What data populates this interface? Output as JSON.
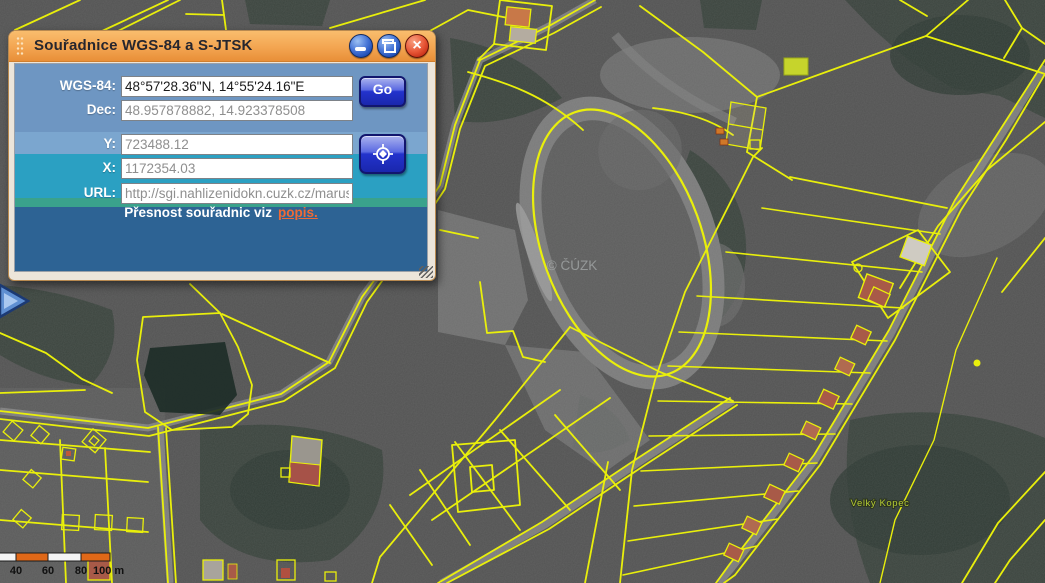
{
  "dialog": {
    "title": "Souřadnice WGS-84 a S-JTSK",
    "fields": [
      {
        "label": "WGS-84:",
        "value": "48°57'28.36\"N, 14°55'24.16\"E"
      },
      {
        "label": "Dec:",
        "value": "48.957878882, 14.923378508"
      },
      {
        "label": "Y:",
        "value": "723488.12"
      },
      {
        "label": "X:",
        "value": "1172354.03"
      },
      {
        "label": "URL:",
        "value": "http://sgi.nahlizenidokn.cuzk.cz/marus"
      }
    ],
    "go_label": "Go",
    "note_text": "Přesnost souřadnic viz",
    "note_link": "popis.",
    "icons": {
      "minimize": "minimize-icon",
      "restore": "restore-icon",
      "close": "close-icon",
      "crosshair": "crosshair-target-icon",
      "drag": "drag-handle-dots-icon",
      "resize": "resize-grip-icon"
    },
    "colors": {
      "title_bar_orange": "#f3a551",
      "band_steel_blue": "#6e96c2",
      "band_teal": "#2ba0c2",
      "band_green": "#3aa28c",
      "band_navy": "#2d6394",
      "button_blue": "#2333cc",
      "close_red": "#e85838",
      "link_orange": "#ef6a35"
    }
  },
  "map": {
    "watermark": "© ČÚZK",
    "place_label": "Velký Kopec",
    "scale_bar": {
      "labels": [
        "40",
        "60",
        "80",
        "100 m"
      ]
    },
    "icons": {
      "expander": "panel-expander-arrow-icon"
    },
    "colors": {
      "parcel_line_yellow": "#e9ef0b",
      "scale_orange": "#e06818"
    }
  }
}
